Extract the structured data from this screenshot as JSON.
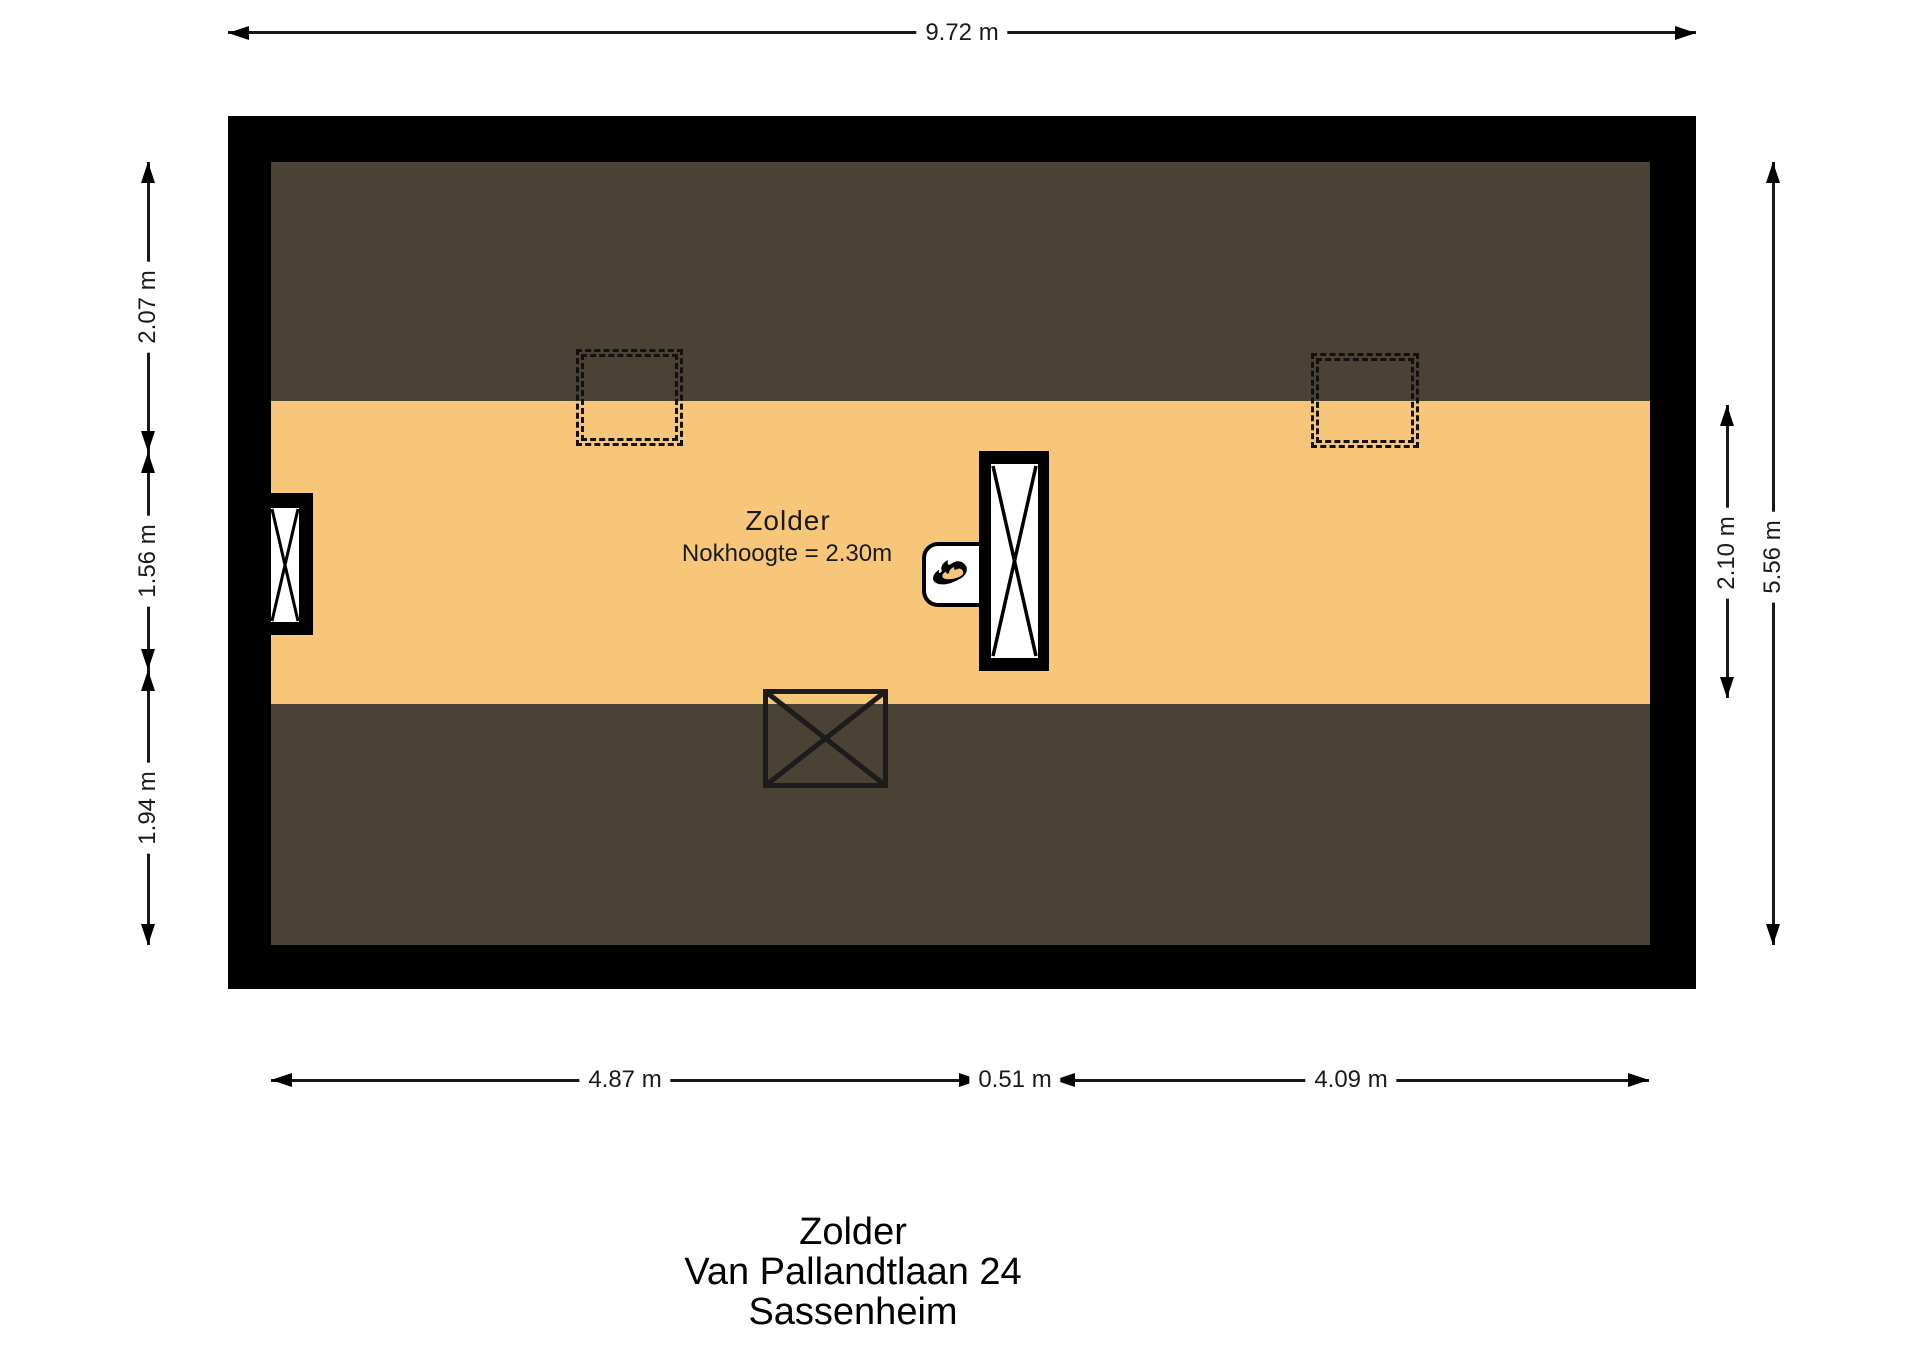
{
  "plan": {
    "room": {
      "name": "Zolder",
      "note": "Nokhoogte = 2.30m"
    },
    "dimensions": {
      "top_total_width": "9.72 m",
      "left_top": "2.07 m",
      "left_middle": "1.56 m",
      "left_bottom": "1.94 m",
      "right_floor_height": "2.10 m",
      "right_total_height": "5.56 m",
      "bottom_left": "4.87 m",
      "bottom_middle": "0.51 m",
      "bottom_right": "4.09 m"
    },
    "title": {
      "line1": "Zolder",
      "line2": "Van Pallandtlaan 24",
      "line3": "Sassenheim"
    },
    "legend": {
      "icons": [
        "skylight-outline-icon",
        "window-icon",
        "chimney-shaft-icon",
        "boiler-flame-icon",
        "stairwell-opening-icon"
      ],
      "colors": {
        "wall": "#000000",
        "low_headroom_area": "#4a4234",
        "floor_area": "#f8c678",
        "background": "#ffffff"
      }
    }
  }
}
